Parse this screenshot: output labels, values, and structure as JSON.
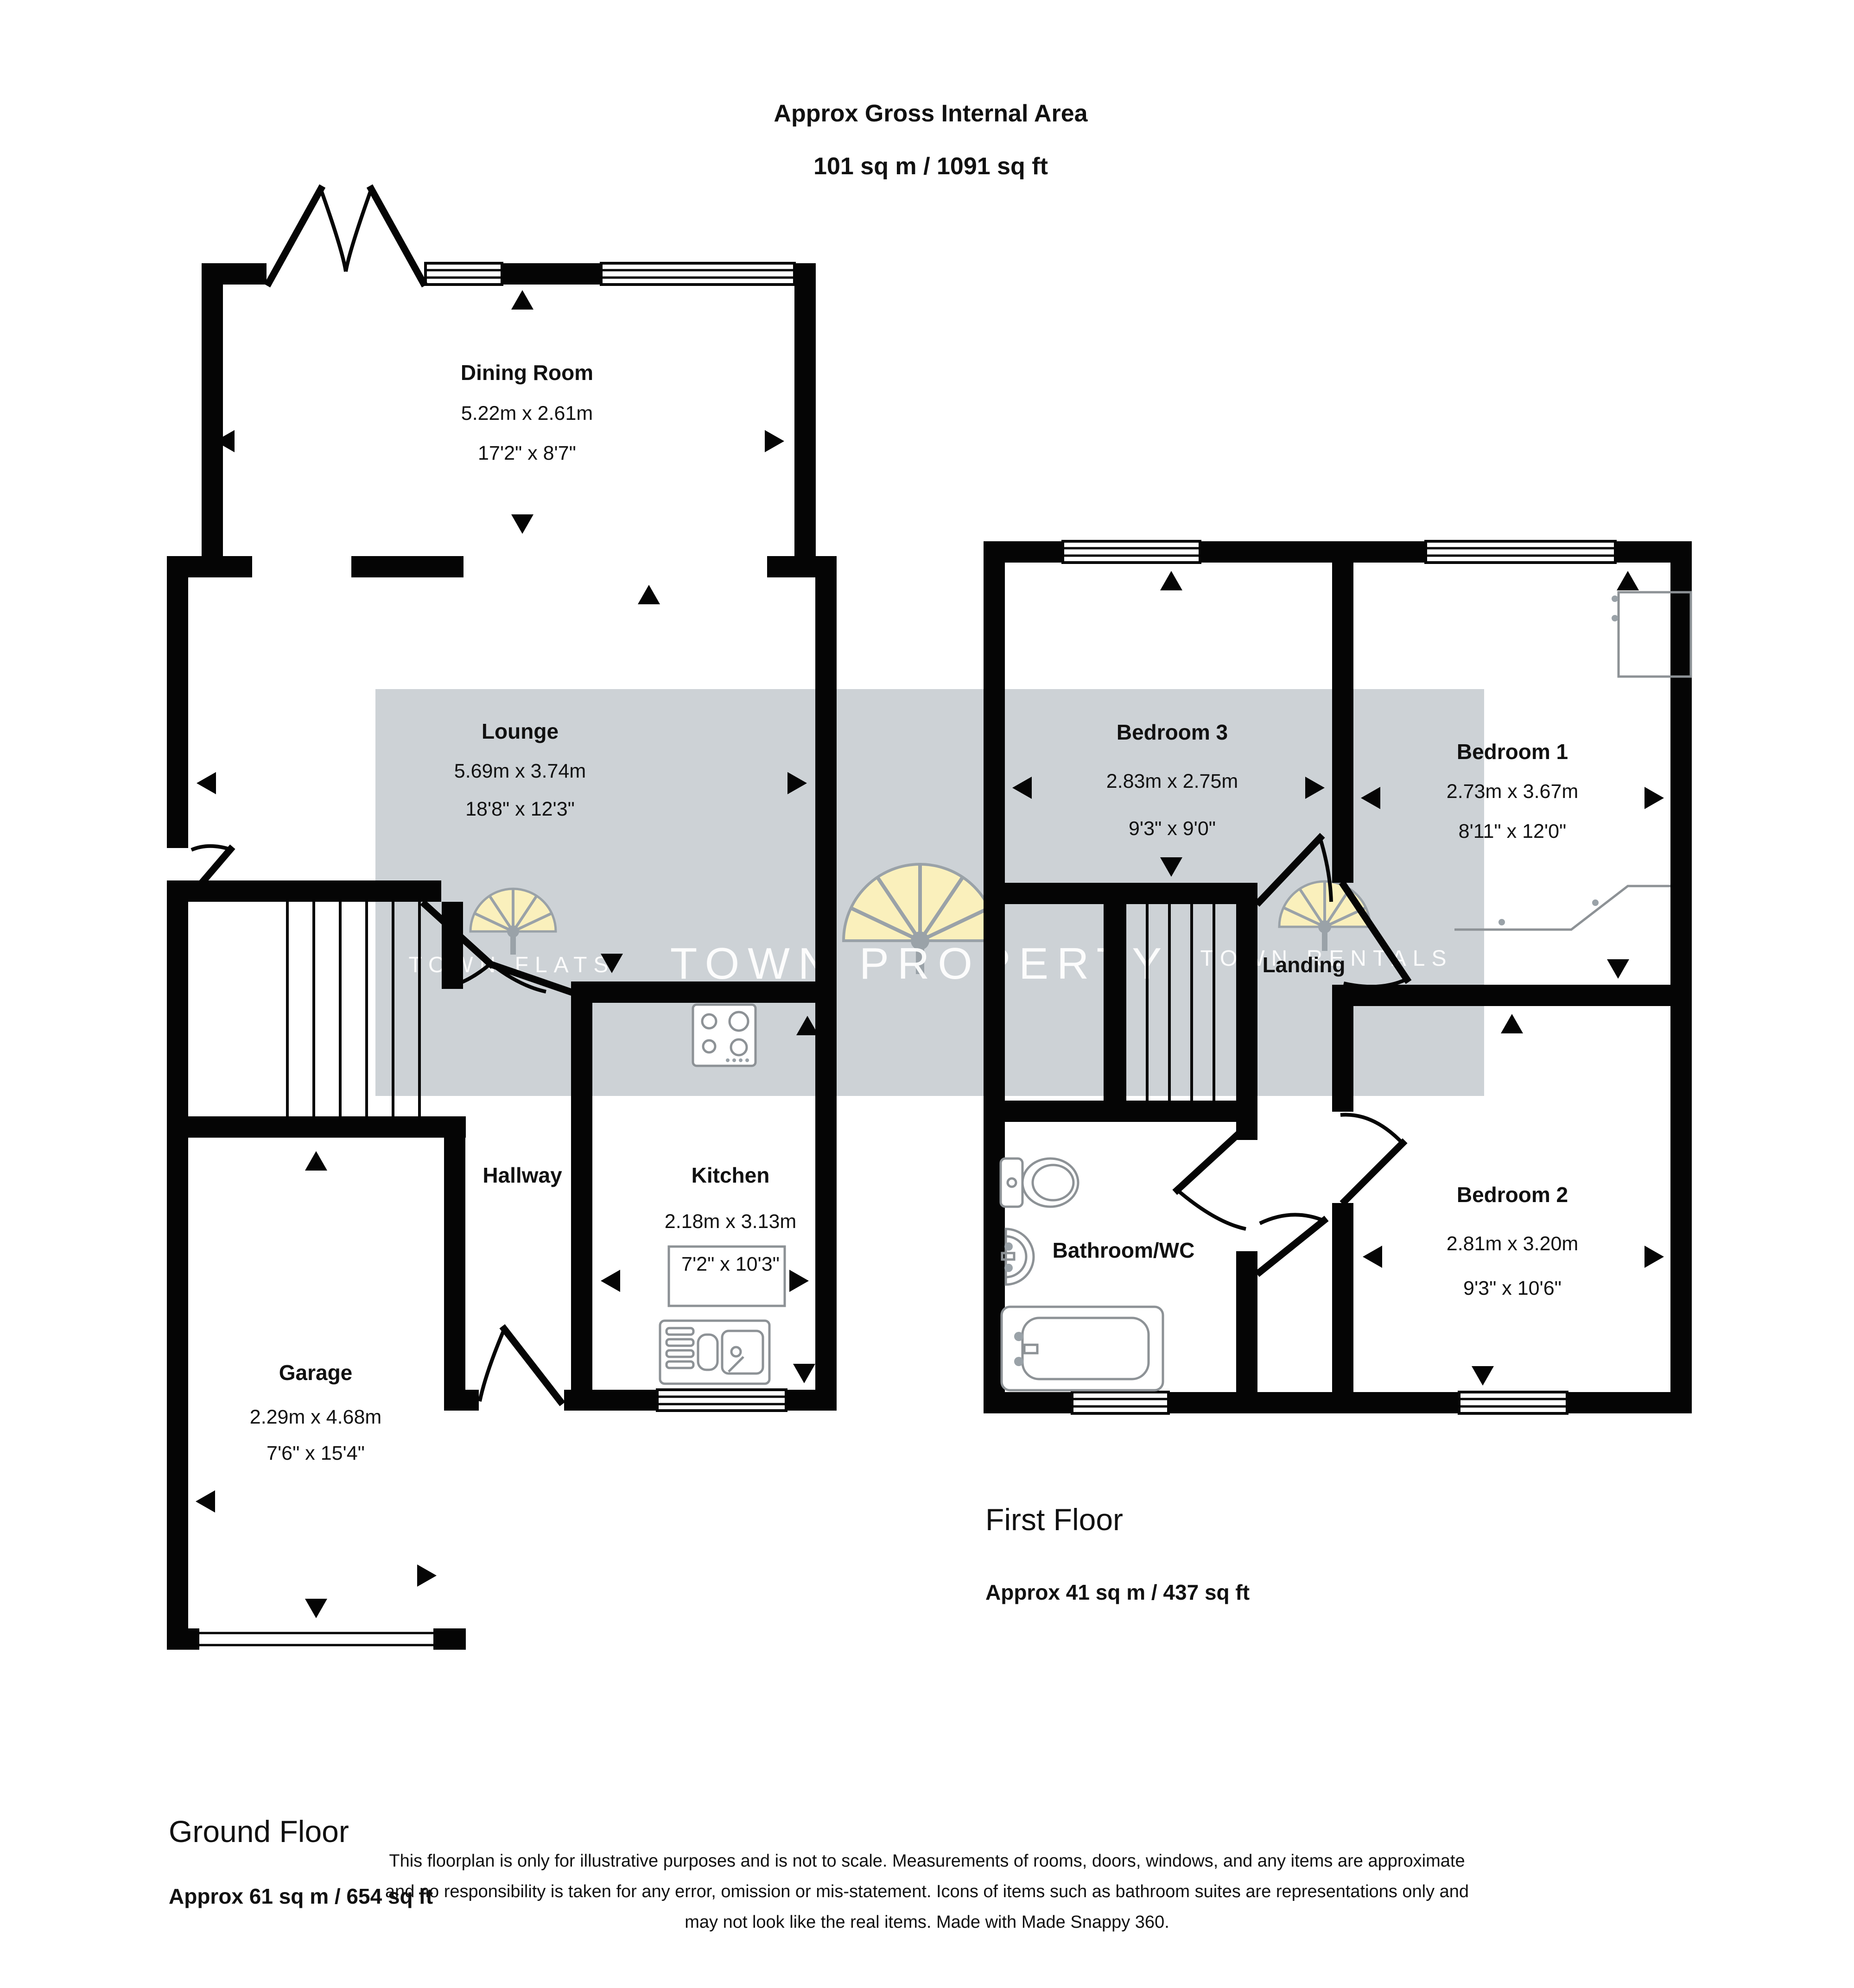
{
  "title": {
    "line1": "Approx Gross Internal Area",
    "line2": "101 sq m / 1091 sq ft"
  },
  "rooms": {
    "dining": {
      "name": "Dining Room",
      "metric": "5.22m x 2.61m",
      "imperial": "17'2\" x 8'7\""
    },
    "lounge": {
      "name": "Lounge",
      "metric": "5.69m x 3.74m",
      "imperial": "18'8\" x 12'3\""
    },
    "hallway": {
      "name": "Hallway"
    },
    "kitchen": {
      "name": "Kitchen",
      "metric": "2.18m x 3.13m",
      "imperial": "7'2\" x 10'3\""
    },
    "garage": {
      "name": "Garage",
      "metric": "2.29m x 4.68m",
      "imperial": "7'6\" x 15'4\""
    },
    "bedroom3": {
      "name": "Bedroom 3",
      "metric": "2.83m x 2.75m",
      "imperial": "9'3\" x 9'0\""
    },
    "bedroom1": {
      "name": "Bedroom 1",
      "metric": "2.73m x 3.67m",
      "imperial": "8'11\" x 12'0\""
    },
    "bedroom2": {
      "name": "Bedroom 2",
      "metric": "2.81m x 3.20m",
      "imperial": "9'3\" x 10'6\""
    },
    "landing": {
      "name": "Landing"
    },
    "bathroom": {
      "name": "Bathroom/WC"
    }
  },
  "floors": {
    "first": {
      "name": "First Floor",
      "area": "Approx 41 sq m / 437 sq ft"
    },
    "ground": {
      "name": "Ground Floor",
      "area": "Approx 61 sq m / 654 sq ft"
    }
  },
  "watermarks": [
    "TOWN FLATS",
    "TOWN PROPERTY",
    "TOWN RENTALS"
  ],
  "disclaimer": {
    "line1": "This floorplan is only for illustrative purposes and is not to scale. Measurements of rooms, doors, windows, and any items are approximate",
    "line2": "and no responsibility is taken for any error, omission or mis-statement. Icons of items such as bathroom suites are representations only and",
    "line3": "may not look like the real items. Made with Made Snappy 360."
  },
  "colors": {
    "wall": "#050505",
    "watermark_band": "#cdd2d6",
    "logo_yellow": "#faf0bc",
    "logo_gray": "#9aa2a8",
    "fixture_gray": "#8d9296"
  }
}
